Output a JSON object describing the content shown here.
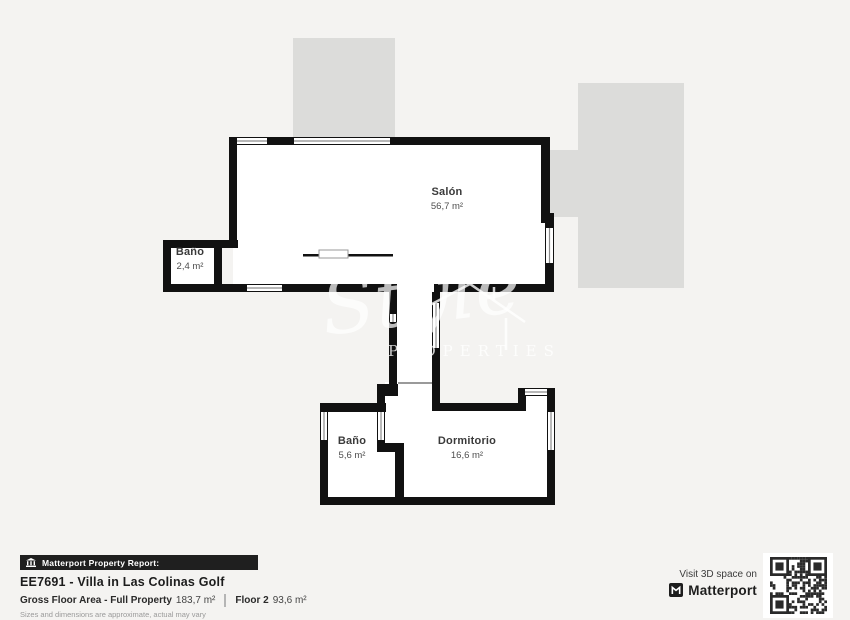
{
  "page": {
    "background": "#f4f3f1",
    "wall_color": "#111111",
    "neighbor_fill": "#dcdcda",
    "badge_bg": "#1f1f1f"
  },
  "watermark": {
    "script": "Style",
    "caption": "PROPERTIES"
  },
  "rooms": [
    {
      "id": "salon",
      "name": "Salón",
      "area": "56,7 m²"
    },
    {
      "id": "bano-small",
      "name": "Baño",
      "area": "2,4 m²"
    },
    {
      "id": "bano",
      "name": "Baño",
      "area": "5,6 m²"
    },
    {
      "id": "dormitorio",
      "name": "Dormitorio",
      "area": "16,6 m²"
    }
  ],
  "footer": {
    "report_badge": "Matterport Property Report:",
    "title": "EE7691 - Villa in Las Colinas Golf",
    "gross_label": "Gross Floor Area - Full Property",
    "gross_value": "183,7 m²",
    "floor_label": "Floor 2",
    "floor_value": "93,6 m²",
    "disclaimer": "Sizes and dimensions are approximate, actual may vary"
  },
  "cta": {
    "visit_text": "Visit 3D space on",
    "brand": "Matterport"
  }
}
